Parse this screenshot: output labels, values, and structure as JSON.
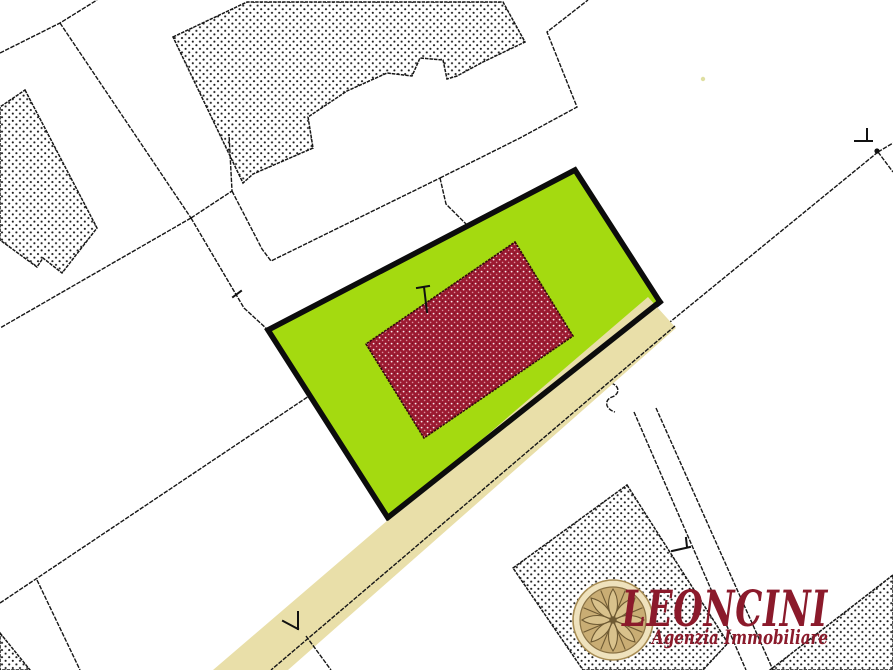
{
  "logo": {
    "name": "LEONCINI",
    "tagline": "Agenzia Immobiliare",
    "emblem": "rosette-icon"
  },
  "colors": {
    "background": "#ffffff",
    "line_black": "#161616",
    "parcel_green": "#a4da10",
    "building_red": "#9c1a31",
    "building_red_speckle": "#ffffff",
    "road_tan": "#e9dfa9",
    "logo_maroon": "#8b1a2b",
    "rosette_ring": "#efe2bd",
    "rosette_inner": "#c9ad74",
    "rosette_petal": "#d9c28c",
    "rosette_line": "#6e5a33",
    "survey_dot_pale_yellow": "#dfdfa2"
  },
  "map": {
    "highlighted_parcel": "green parcel with red hatched building",
    "road": "diagonal tan strip",
    "building_fill": "dot-stipple hatching"
  }
}
